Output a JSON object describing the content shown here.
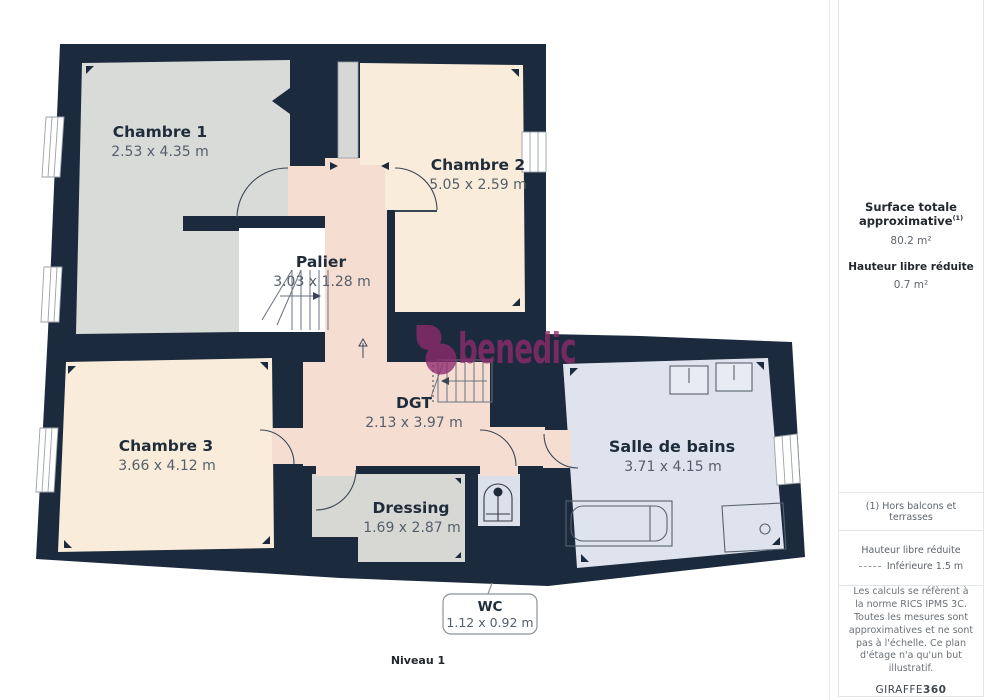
{
  "plan": {
    "level_label": "Niveau 1",
    "watermark": "benedic",
    "rooms": {
      "chambre1": {
        "name": "Chambre 1",
        "dims": "2.53 x 4.35 m"
      },
      "chambre2": {
        "name": "Chambre 2",
        "dims": "5.05 x 2.59 m"
      },
      "palier": {
        "name": "Palier",
        "dims": "3.03 x 1.28 m"
      },
      "dgt": {
        "name": "DGT",
        "dims": "2.13 x 3.97 m"
      },
      "chambre3": {
        "name": "Chambre 3",
        "dims": "3.66 x 4.12 m"
      },
      "dressing": {
        "name": "Dressing",
        "dims": "1.69 x 2.87 m"
      },
      "salle_de_bains": {
        "name": "Salle de bains",
        "dims": "3.71 x 4.15 m"
      },
      "wc": {
        "name": "WC",
        "dims": "1.12 x 0.92 m"
      }
    },
    "colors": {
      "wall": "#1b2a3c",
      "room_gray": "#d9dbd8",
      "room_cream": "#faecda",
      "room_pink": "#f6ddd2",
      "room_blue": "#dfe3ee",
      "watermark": "#8f2b6d"
    }
  },
  "sidebar": {
    "surface_title": "Surface totale approximative",
    "surface_sup": "(1)",
    "surface_value": "80.2 m²",
    "height_title": "Hauteur libre réduite",
    "height_value": "0.7 m²",
    "footnote": "(1) Hors balcons et terrasses",
    "legend_title": "Hauteur libre réduite",
    "legend_value": "Inférieure 1.5 m",
    "disclaimer": "Les calculs se réfèrent à la norme RICS IPMS 3C. Toutes les mesures sont approximatives et ne sont pas à l'échelle. Ce plan d'étage n'a qu'un but illustratif.",
    "brand": "GIRAFFE",
    "brand_bold": "360"
  }
}
